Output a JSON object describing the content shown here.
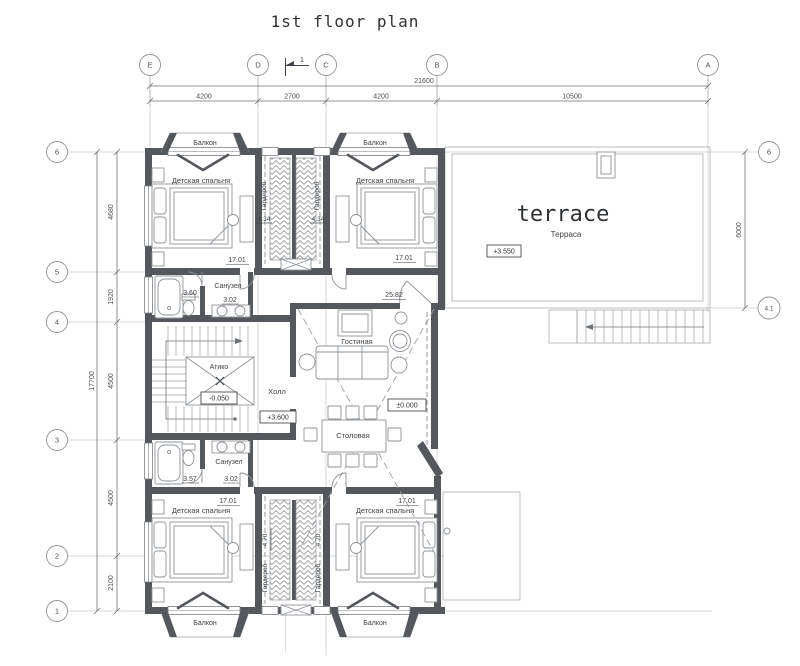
{
  "title": "1st floor plan",
  "colors": {
    "wall": "#54585c",
    "furniture_line": "#8e9398",
    "grid_line": "#c8cacc",
    "dimension_line": "#6f7377",
    "text": "#3f4347"
  },
  "axes": {
    "top": {
      "e": "E",
      "d": "D",
      "c": "C",
      "b": "B",
      "a": "A"
    },
    "left": {
      "r6": "6",
      "r5": "5",
      "r4": "4",
      "r3": "3",
      "r2": "2",
      "r1": "1"
    },
    "right": {
      "r6": "6",
      "r41": "4.1"
    }
  },
  "section": {
    "label": "1"
  },
  "dims": {
    "top_total": "21600",
    "ed": "4200",
    "dc": "2700",
    "cb": "4200",
    "ba": "10500",
    "left_total": "17700",
    "d65": "4680",
    "d54": "1920",
    "d43": "4500",
    "d32": "4500",
    "d21": "2100",
    "right": "6000"
  },
  "rooms": {
    "bedroom": "Детская спальня",
    "balcony": "Балкон",
    "wardrobe": "Гардероб",
    "bathroom": "Санузел",
    "atrium": "Атико",
    "hall": "Холл",
    "living": "Гостиная",
    "dining": "Столовая",
    "terrace_en": "terrace",
    "terrace_ru": "Терраса"
  },
  "areas": {
    "bedroom_tl": "17.01",
    "bedroom_tr": "17.01",
    "bedroom_bl": "17.01",
    "bedroom_br": "17.01",
    "wardrobe_top_left": "4.34",
    "wardrobe_top_right": "4.34",
    "wardrobe_bottom_left": "4.70",
    "wardrobe_bottom_right": "4.70",
    "bath_top_tub": "3.60",
    "bath_top_wc": "3.02",
    "bath_bottom_tub": "3.57",
    "bath_bottom_wc": "3.02",
    "living": "25.82"
  },
  "elevations": {
    "atrium": "-0.050",
    "hall": "+3.600",
    "living": "±0.000",
    "terrace": "+3.550"
  }
}
